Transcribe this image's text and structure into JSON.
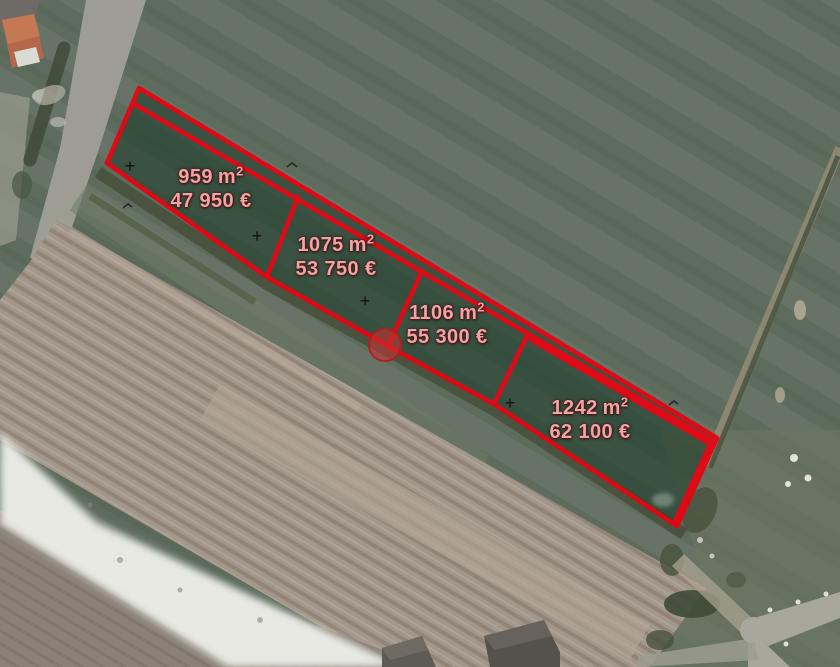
{
  "parcels": [
    {
      "area_value": "959",
      "area_unit": "m",
      "area_exponent": "2",
      "price": "47 950 €"
    },
    {
      "area_value": "1075",
      "area_unit": "m",
      "area_exponent": "2",
      "price": "53 750 €"
    },
    {
      "area_value": "1106",
      "area_unit": "m",
      "area_exponent": "2",
      "price": "55 300 €"
    },
    {
      "area_value": "1242",
      "area_unit": "m",
      "area_exponent": "2",
      "price": "62 100 €"
    }
  ],
  "icons": {
    "survey_cross": "+"
  },
  "colors": {
    "overlay_red": "#e30613",
    "overlay_fill": "#0d2f1b",
    "label_pink": "#f4a2a6",
    "field_green": "#5e6c5e",
    "plow_tan": "#a3978b",
    "white_band": "#e7e9e2",
    "road_gray": "#a7a79c",
    "roof_orange": "#b4674b",
    "marker_black": "#101010"
  }
}
